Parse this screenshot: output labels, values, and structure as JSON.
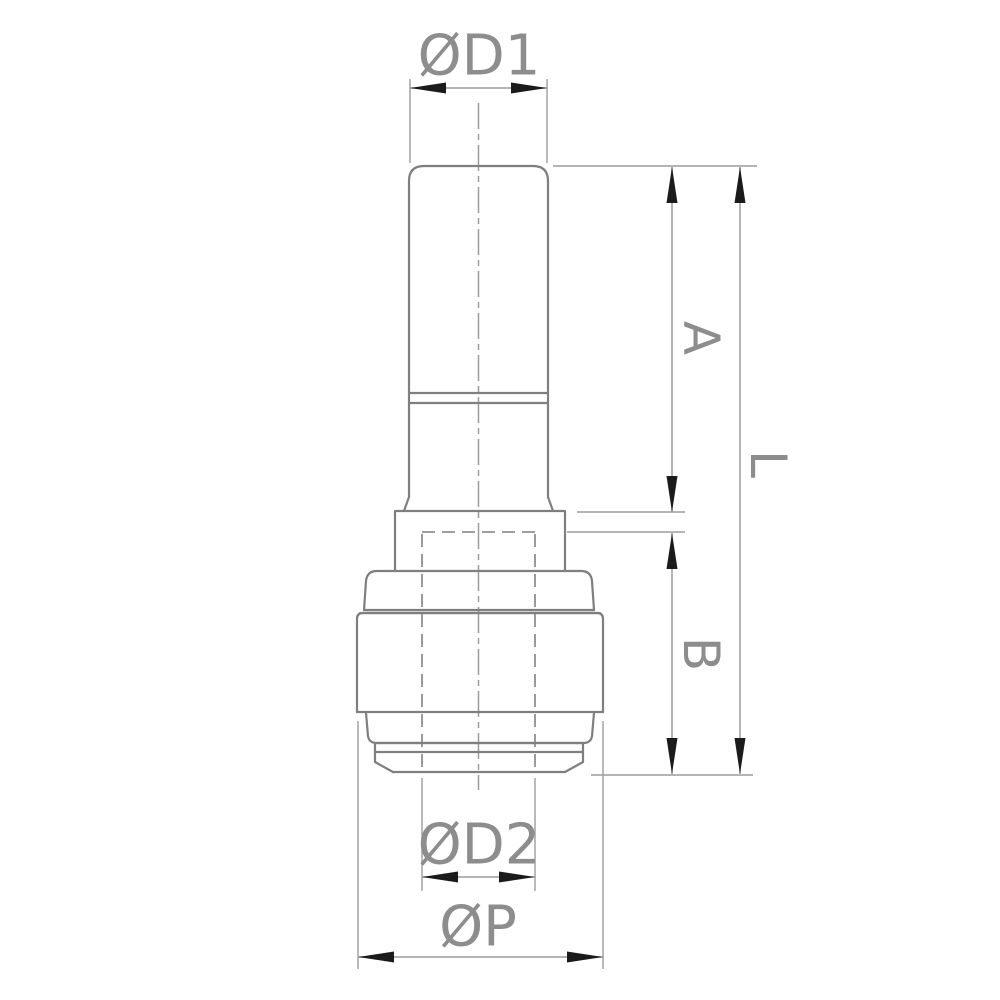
{
  "drawing": {
    "description": "Technical dimension drawing of a push-fit tube reducer fitting, front view",
    "dimension_labels": {
      "d1": "ØD1",
      "a": "A",
      "l": "L",
      "b": "B",
      "d2": "ØD2",
      "p": "ØP"
    }
  },
  "colors": {
    "background": "#ffffff",
    "outline": "#7f7f7f",
    "dimension": "#9c9c9c",
    "hidden": "#909090",
    "centerline": "#9c9c9c",
    "text": "#8d8d8d",
    "arrow": "#1b1b1b"
  }
}
